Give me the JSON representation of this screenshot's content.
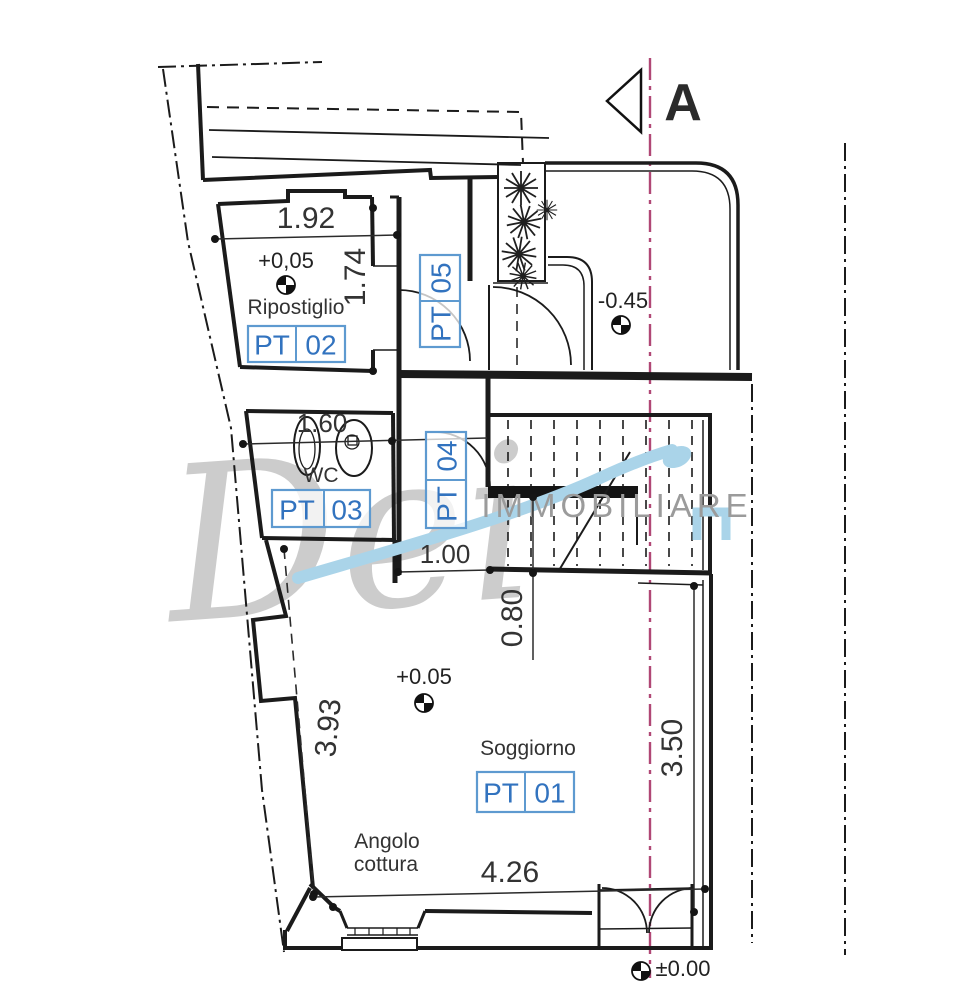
{
  "section_marker": {
    "label": "A"
  },
  "watermark": {
    "script": "Dei",
    "caption": "IMMOBILIARE"
  },
  "rooms": {
    "ripostiglio": {
      "name": "Ripostiglio",
      "elevation": "+0,05",
      "unit_prefix": "PT",
      "unit_number": "02"
    },
    "wc": {
      "name": "WC",
      "unit_prefix": "PT",
      "unit_number": "03"
    },
    "soggiorno": {
      "name": "Soggiorno",
      "elevation": "+0.05",
      "unit_prefix": "PT",
      "unit_number": "01"
    },
    "kitchen": {
      "name_line1": "Angolo",
      "name_line2": "cottura"
    },
    "hall": {
      "unit_prefix": "PT",
      "unit_number": "04"
    },
    "corridor": {
      "unit_prefix": "PT",
      "unit_number": "05"
    }
  },
  "dimensions": {
    "ripostiglio_width": "1.92",
    "ripostiglio_depth": "1.74",
    "wc_width": "1.60",
    "passage_width": "1.00",
    "stair_passage": "0.80",
    "soggiorno_left": "3.93",
    "soggiorno_right": "3.50",
    "soggiorno_width": "4.26"
  },
  "elevations": {
    "terrace": "-0.45",
    "entrance": "±0.00"
  },
  "colors": {
    "label_blue": "#3273bf",
    "label_box_border": "#5e9ad0",
    "section_line": "#b04775",
    "line_black": "#1b1b1b",
    "watermark_gray": "#9b9b9b",
    "watermark_blue": "#a7d3e8"
  }
}
